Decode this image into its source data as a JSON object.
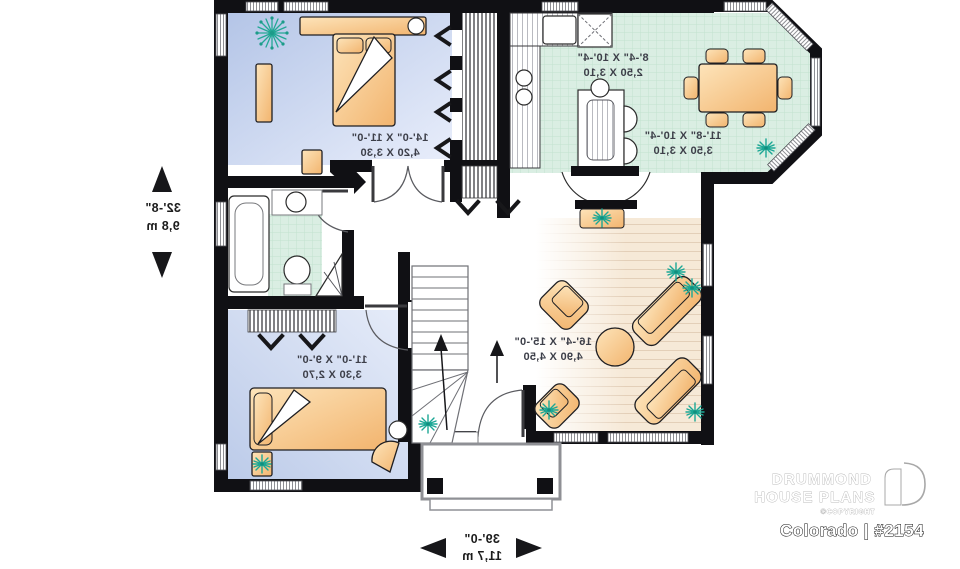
{
  "meta": {
    "document_type": "floor plan",
    "orientation": "reversed (mirrored text)"
  },
  "branding": {
    "name_line1": "DRUMMOND",
    "name_line2": "HOUSE PLANS",
    "copyright": "©COPYRIGHT",
    "plan_label": "Colorado | #2154"
  },
  "dimensions": {
    "depth_imperial": "32'-8\"",
    "depth_metric": "9,8 m",
    "width_imperial": "39'-0\"",
    "width_metric": "11,7 m"
  },
  "rooms": {
    "master_bedroom": {
      "imperial": "14'-0\" X 11'-0\"",
      "metric": "4,20 X 3,30"
    },
    "kitchen": {
      "imperial": "8'-4\" X 10'-4\"",
      "metric": "2,50 X 3,10"
    },
    "dining_room": {
      "imperial": "11'-8\" X 10'-4\"",
      "metric": "3,50 X 3,10"
    },
    "living_room": {
      "imperial": "16'-4\" X 15'-0\"",
      "metric": "4,90 X 4,50"
    },
    "bedroom_2": {
      "imperial": "11'-0\" X 9'-0\"",
      "metric": "3,30 X 2,70"
    }
  },
  "colors": {
    "wall": "#101014",
    "bedroom_floor": "#c3d2ec",
    "tile_floor": "#daeee3",
    "wood_floor": "#f6e9d7",
    "furniture": "#f8c98c",
    "plant": "#1ca795"
  }
}
